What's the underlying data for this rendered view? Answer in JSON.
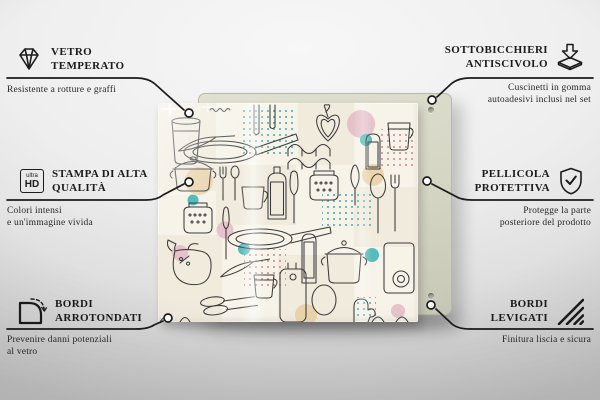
{
  "callouts": [
    {
      "id": "vetro-temperato",
      "icon": "diamond-icon",
      "title1": "VETRO",
      "title2": "TEMPERATO",
      "sub1": "Resistente a rotture e graffi",
      "sub2": ""
    },
    {
      "id": "stampa-di-alta-qualita",
      "icon": "ultra-hd-icon",
      "title1": "STAMPA DI ALTA",
      "title2": "QUALITÀ",
      "sub1": "Colori intensi",
      "sub2": "e un'immagine vivida"
    },
    {
      "id": "bordi-arrotondati",
      "icon": "rounded-corner-icon",
      "title1": "BORDI",
      "title2": "ARROTONDATI",
      "sub1": "Prevenire danni potenziali",
      "sub2": "al vetro"
    },
    {
      "id": "sottobicchieri-antiscivolo",
      "icon": "anti-slip-pad-icon",
      "title1": "SOTTOBICCHIERI",
      "title2": "ANTISCIVOLO",
      "sub1": "Cuscinetti in gomma",
      "sub2": "autoadesivi inclusi nel set"
    },
    {
      "id": "pellicola-protettiva",
      "icon": "shield-check-icon",
      "title1": "PELLICOLA",
      "title2": "PROTETTIVA",
      "sub1": "Protegge la parte",
      "sub2": "posteriore del prodotto"
    },
    {
      "id": "bordi-levigati",
      "icon": "polished-edge-icon",
      "title1": "BORDI",
      "title2": "LEVIGATI",
      "sub1": "Finitura liscia e sicura",
      "sub2": ""
    }
  ],
  "uhd": {
    "top": "ultra",
    "bottom": "HD"
  },
  "product": {
    "description": "Pannello in vetro con motivo di utensili da cucina disegnati a linea, cerchi pastello e pois"
  },
  "colors": {
    "ink": "#1b1b1b",
    "line": "#3a3a3a",
    "glass-bg": "#f7f3e9",
    "panel": "#d6d6c5",
    "pink": "#e4bac7",
    "tan": "#e7cfa2",
    "teal": "#3eb7b7",
    "teal-dot": "#39b0b0",
    "red-dot": "#b2657a",
    "bg-top": "#f7f7f7",
    "bg-bottom": "#c7c7c7"
  }
}
